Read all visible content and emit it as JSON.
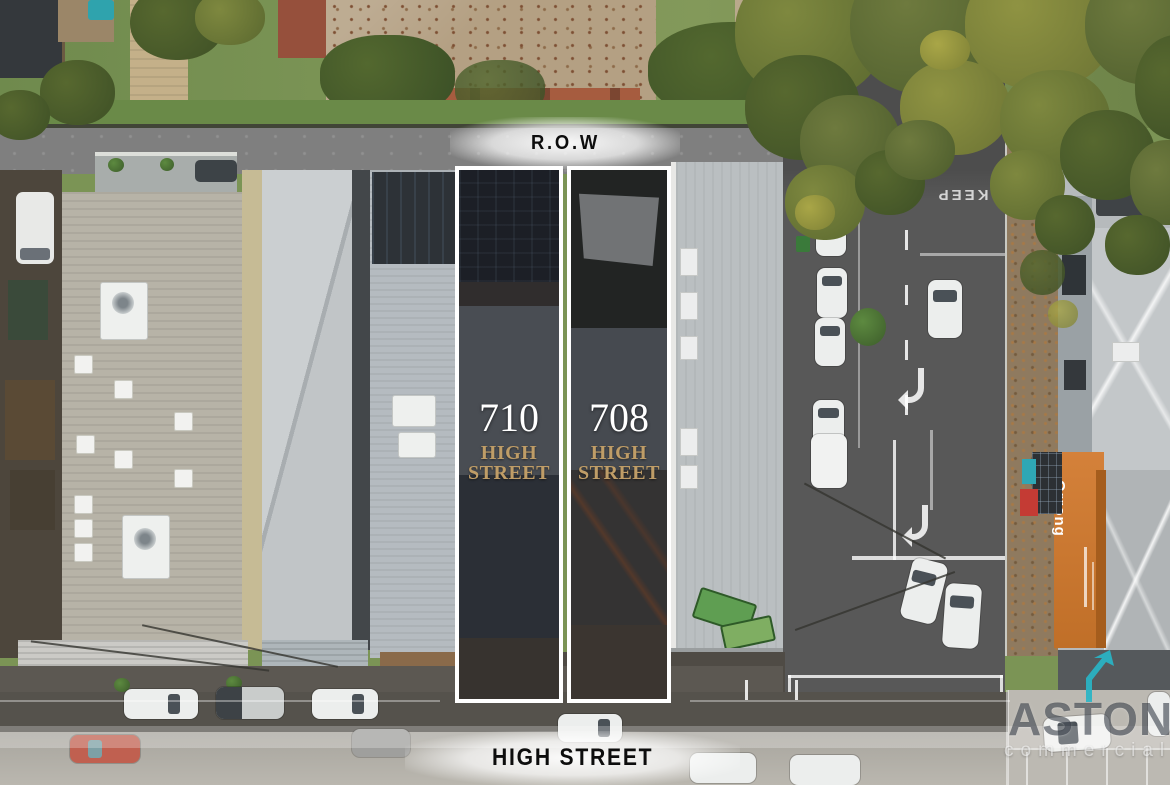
{
  "annotations": {
    "row_label": "R.O.W",
    "street_label": "HIGH STREET"
  },
  "properties": [
    {
      "number": "710",
      "street_word1": "HIGH",
      "street_word2": "STREET"
    },
    {
      "number": "708",
      "street_word1": "HIGH",
      "street_word2": "STREET"
    }
  ],
  "photo_text": {
    "road_marking": "KEEP",
    "shop_sign": "Orrong"
  },
  "watermark": {
    "brand": "ASTON",
    "division": "commercial"
  },
  "colors": {
    "address_gold": "#bf9d67",
    "outline_white": "#ffffff",
    "logo_teal": "#29b5c6",
    "awning_orange": "#cf7e35"
  }
}
